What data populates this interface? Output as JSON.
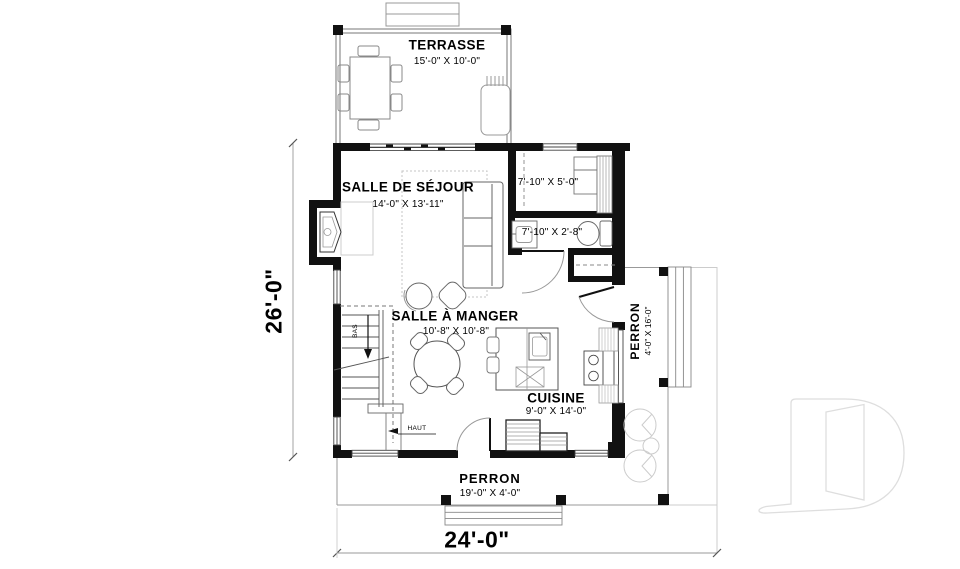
{
  "labels": {
    "terrasse": {
      "name": "TERRASSE",
      "dim": "15'-0\" X 10'-0\""
    },
    "salle_de_sejour": {
      "name": "SALLE DE SÉJOUR",
      "dim": "14'-0\" X 13'-11\""
    },
    "mudroom": {
      "dim": "7'-10\" X 5'-0\""
    },
    "powder": {
      "dim": "7'-10\" X 2'-8\""
    },
    "salle_a_manger": {
      "name": "SALLE À MANGER",
      "dim": "10'-8\" X 10'-8\""
    },
    "cuisine": {
      "name": "CUISINE",
      "dim": "9'-0\" X 14'-0\""
    },
    "perron_right": {
      "name": "PERRON",
      "dim": "4'-0\" X 16'-0\""
    },
    "perron_bottom": {
      "name": "PERRON",
      "dim": "19'-0\" X 4'-0\""
    },
    "stairs": {
      "down": "BAS",
      "up": "HAUT"
    },
    "dimensions": {
      "width": "24'-0\"",
      "height": "26'-0\""
    }
  },
  "colors": {
    "wall": "#111111",
    "fixture_line": "#666666",
    "light_line": "#cccccc",
    "watermark": "#dedede",
    "text": "#000000"
  }
}
